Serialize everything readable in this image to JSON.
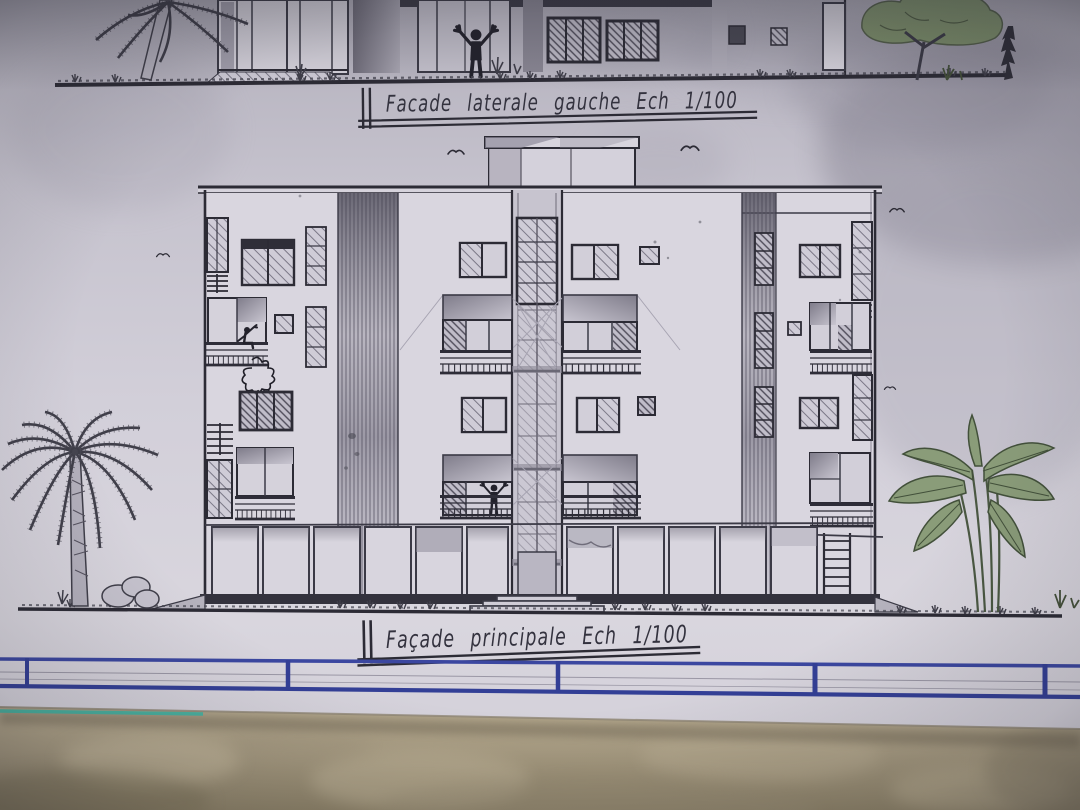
{
  "photo": {
    "type": "photograph of hand-drawn architectural elevation drawings on paper, lying on a marble floor",
    "captions": {
      "top_elevation": "Facade laterale gauche Ech 1/100",
      "main_elevation": "Façade principale Ech 1/100"
    },
    "scale_note": "Ech 1/100"
  },
  "main_elevation": {
    "floors_visible": 4,
    "features": [
      "central glazed stair tower",
      "rooftop bulkhead",
      "balconies with railings",
      "shaded recessed bays",
      "ground-floor panel row",
      "entrance steps",
      "side ladder"
    ],
    "figures_count": 3,
    "birds_count": 5,
    "vegetation": [
      "palm tree",
      "banana plant",
      "green tree",
      "dark cypress",
      "rocks",
      "grass",
      "shrubs"
    ]
  },
  "colors": {
    "paper": "#cfccd7",
    "ink": "#3b3a46",
    "pencil_shade": "#8f8c9b",
    "title_block_blue": "#3b47a0",
    "foliage_green": "#7e9268",
    "marble_floor": "#b0a489",
    "teal_edge": "#3fb3a2"
  }
}
